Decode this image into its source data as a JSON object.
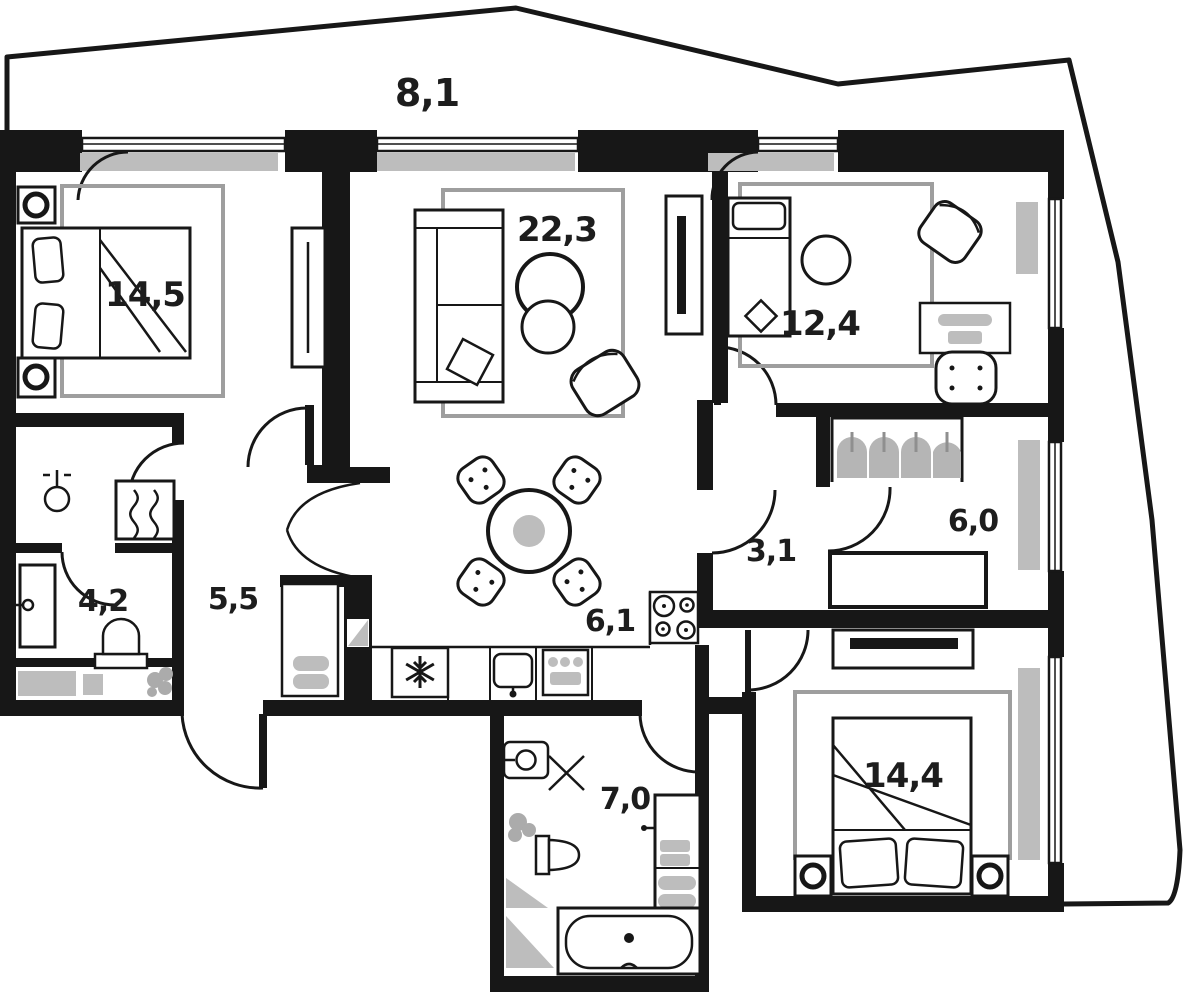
{
  "plan": {
    "type": "apartment-floor-plan",
    "rooms": [
      {
        "name": "balcony",
        "area_label": "8,1"
      },
      {
        "name": "bedroom-1",
        "area_label": "14,5"
      },
      {
        "name": "living-room",
        "area_label": "22,3"
      },
      {
        "name": "bedroom-2",
        "area_label": "12,4"
      },
      {
        "name": "dressing-room",
        "area_label": "6,0"
      },
      {
        "name": "hallway",
        "area_label": "3,1"
      },
      {
        "name": "corridor",
        "area_label": "5,5"
      },
      {
        "name": "bathroom-small",
        "area_label": "4,2"
      },
      {
        "name": "kitchen",
        "area_label": "6,1"
      },
      {
        "name": "bathroom-main",
        "area_label": "7,0"
      },
      {
        "name": "bedroom-3",
        "area_label": "14,4"
      }
    ],
    "icons": [
      "bed",
      "pillow",
      "wardrobe",
      "sofa",
      "coffee-table",
      "armchair",
      "tv-console",
      "dining-table",
      "chair",
      "fridge-snowflake",
      "kitchen-sink",
      "oven",
      "stove",
      "toilet",
      "shower-tray",
      "washing-machine",
      "bathtub",
      "clothes-hangers",
      "desk",
      "desk-chair",
      "ottoman",
      "radiator",
      "window",
      "door-swing",
      "plant",
      "shoe-cabinet",
      "nightstand-lamp"
    ],
    "colors": {
      "walls": "#171717",
      "radiator": "#c9c9c9",
      "rug": "#9e9e9e",
      "accent_gray": "#b5b5b5",
      "background": "#ffffff",
      "label": "#1d1d1d"
    }
  }
}
